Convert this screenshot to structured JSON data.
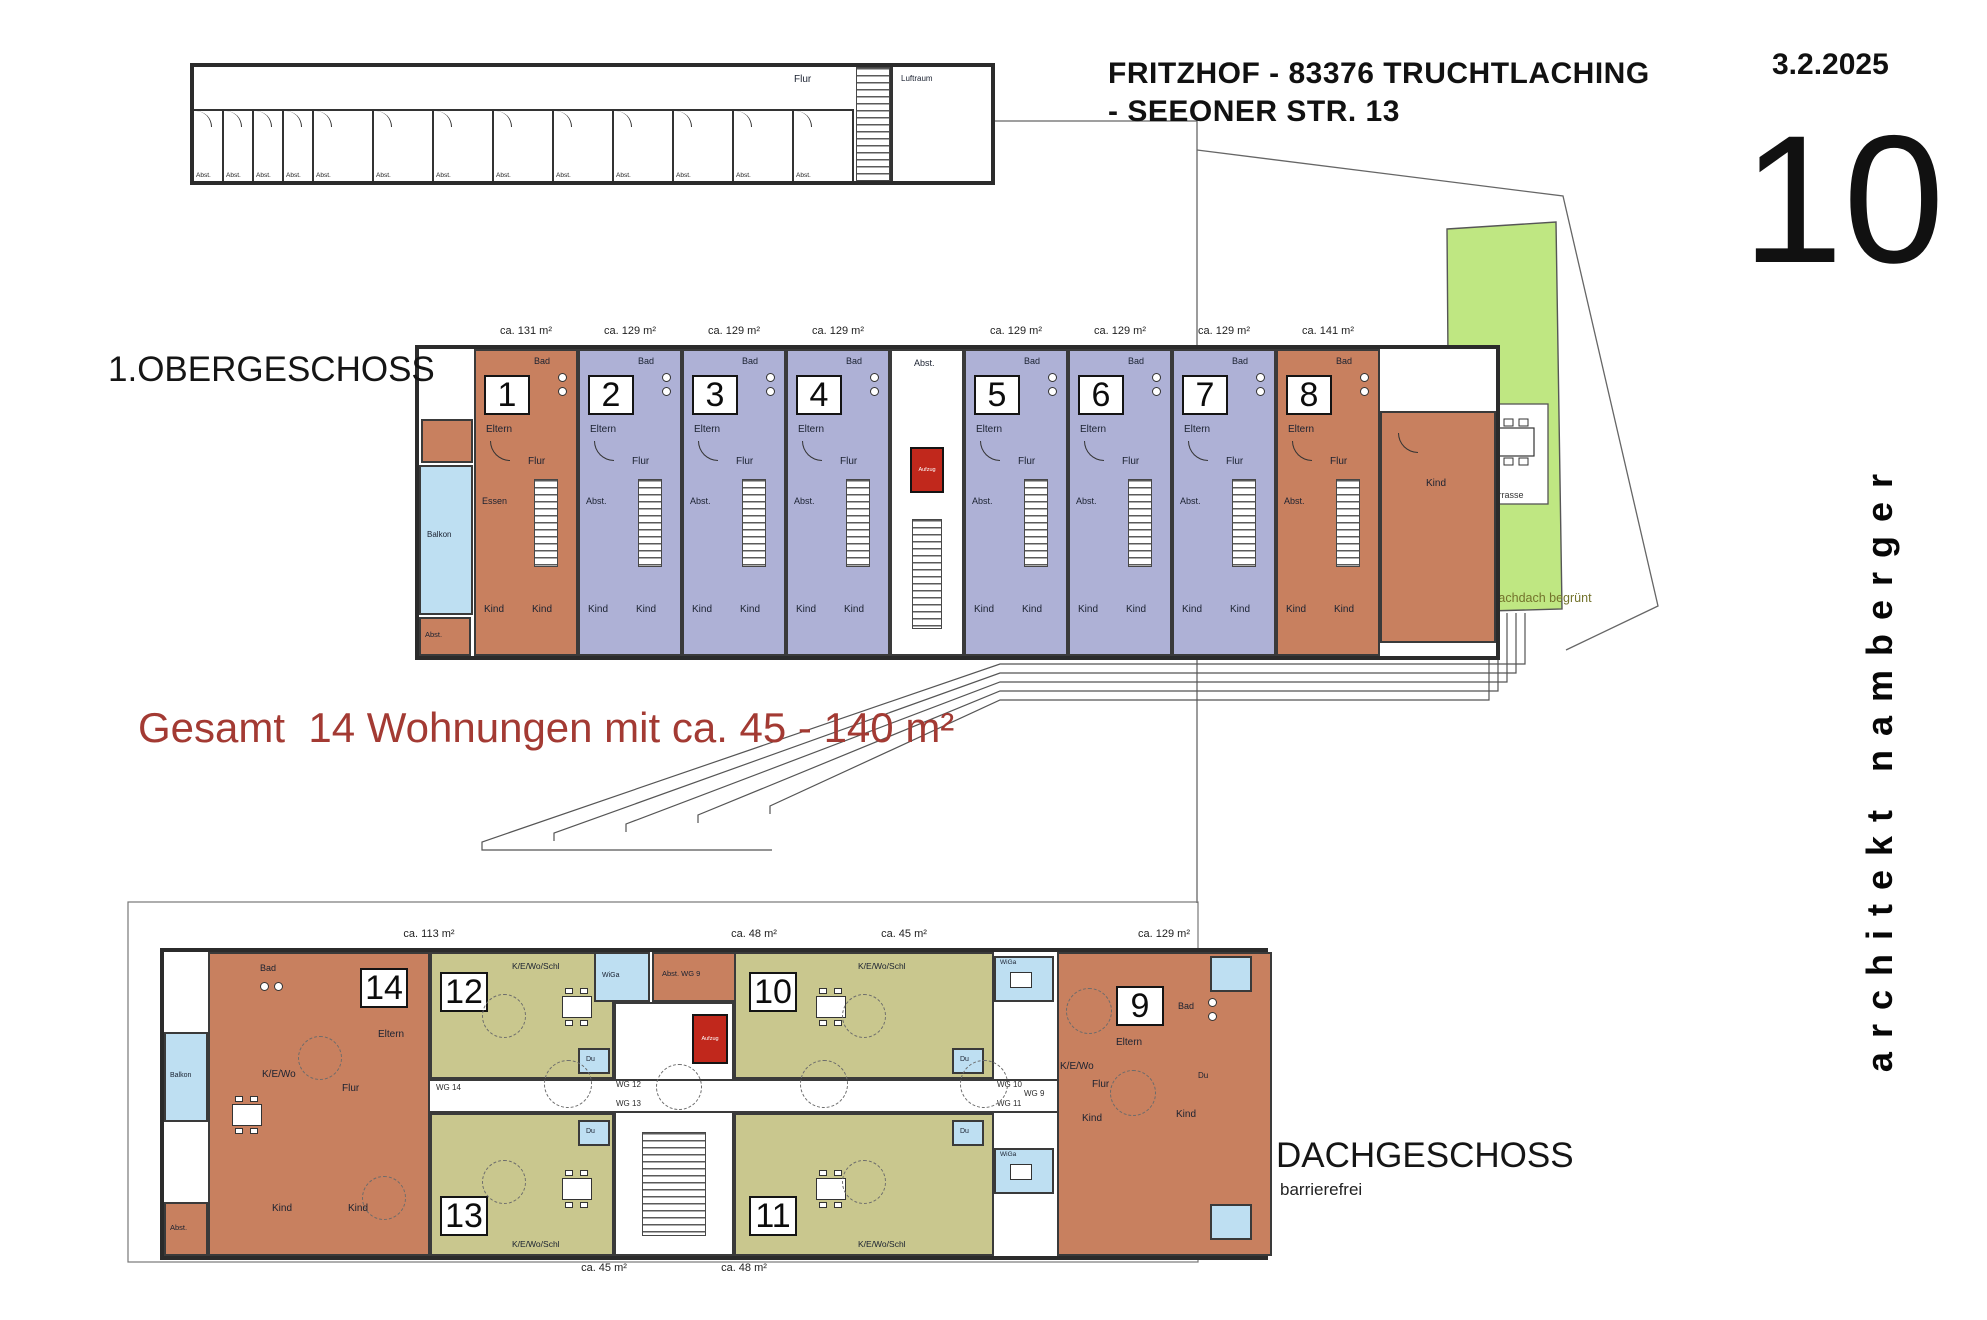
{
  "header": {
    "title_line1": "FRITZHOF - 83376 TRUCHTLACHING",
    "title_line2": "- SEEONER STR. 13",
    "date": "3.2.2025",
    "sheet_number": "10",
    "architect": "architekt namberger"
  },
  "summary": {
    "text": "Gesamt  14 Wohnungen mit ca. 45 - 140 m²"
  },
  "basement": {
    "corridor_label": "Flur",
    "airspace_label": "Luftraum",
    "storage_label": "Abst.",
    "cells": 13
  },
  "first_floor": {
    "label": "1.OBERGESCHOSS",
    "balcony_label": "Balkon",
    "wing_storage_label": "Abst.",
    "stairwell": {
      "storage_label": "Abst.",
      "elevator_label": "Aufzug"
    },
    "right_wing_room": "Kind",
    "units": [
      {
        "no": "1",
        "area": "ca. 131 m²",
        "fill": "#c8805f",
        "rooms": [
          "Eltern",
          "Bad",
          "Flur",
          "Essen",
          "Kind",
          "Kind"
        ]
      },
      {
        "no": "2",
        "area": "ca. 129 m²",
        "fill": "#aeb1d6",
        "rooms": [
          "Eltern",
          "Bad",
          "Flur",
          "Abst.",
          "Kind",
          "Kind"
        ]
      },
      {
        "no": "3",
        "area": "ca. 129 m²",
        "fill": "#aeb1d6",
        "rooms": [
          "Eltern",
          "Bad",
          "Flur",
          "Abst.",
          "Kind",
          "Kind"
        ]
      },
      {
        "no": "4",
        "area": "ca. 129 m²",
        "fill": "#aeb1d6",
        "rooms": [
          "Eltern",
          "Bad",
          "Flur",
          "Abst.",
          "Kind",
          "Kind"
        ]
      },
      {
        "no": "5",
        "area": "ca. 129 m²",
        "fill": "#aeb1d6",
        "rooms": [
          "Eltern",
          "Bad",
          "Flur",
          "Abst.",
          "Kind",
          "Kind"
        ]
      },
      {
        "no": "6",
        "area": "ca. 129 m²",
        "fill": "#aeb1d6",
        "rooms": [
          "Eltern",
          "Bad",
          "Flur",
          "Abst.",
          "Kind",
          "Kind"
        ]
      },
      {
        "no": "7",
        "area": "ca. 129 m²",
        "fill": "#aeb1d6",
        "rooms": [
          "Eltern",
          "Bad",
          "Flur",
          "Abst.",
          "Kind",
          "Kind"
        ]
      },
      {
        "no": "8",
        "area": "ca. 141 m²",
        "fill": "#c8805f",
        "rooms": [
          "Eltern",
          "Bad",
          "Flur",
          "Abst.",
          "Kind",
          "Kind"
        ]
      }
    ]
  },
  "site": {
    "lawn_label": "Flachdach begrünt",
    "terrace_label": "Terrasse"
  },
  "attic": {
    "label": "DACHGESCHOSS",
    "sublabel": "barrierefrei",
    "areas_top": [
      "ca. 113 m²",
      "ca. 48 m²",
      "ca. 45 m²",
      "ca. 129 m²"
    ],
    "areas_bottom": [
      "ca. 45 m²",
      "ca. 48 m²"
    ],
    "balcony_label": "Balkon",
    "wing_storage_label": "Abst.",
    "wintergarten_label": "WiGa",
    "shower_label": "Du",
    "storage_wg_label": "Abst. WG 9",
    "stair_elevator_label": "Aufzug",
    "door_tags": [
      "WG 14",
      "WG 12",
      "WG 13",
      "WG 10",
      "WG 11",
      "WG 9"
    ],
    "units": [
      {
        "no": "14",
        "fill": "#c8805f",
        "rooms": [
          "Bad",
          "Eltern",
          "K/E/Wo",
          "Flur",
          "Kind",
          "Kind"
        ]
      },
      {
        "no": "12",
        "fill": "#c9c78e",
        "rooms": [
          "K/E/Wo/Schl"
        ]
      },
      {
        "no": "13",
        "fill": "#c9c78e",
        "rooms": [
          "K/E/Wo/Schl"
        ]
      },
      {
        "no": "10",
        "fill": "#c9c78e",
        "rooms": [
          "K/E/Wo/Schl"
        ]
      },
      {
        "no": "11",
        "fill": "#c9c78e",
        "rooms": [
          "K/E/Wo/Schl"
        ]
      },
      {
        "no": "9",
        "fill": "#c8805f",
        "rooms": [
          "Eltern",
          "Bad",
          "Flur",
          "K/E/Wo",
          "Kind",
          "Kind",
          "Du"
        ]
      }
    ]
  }
}
